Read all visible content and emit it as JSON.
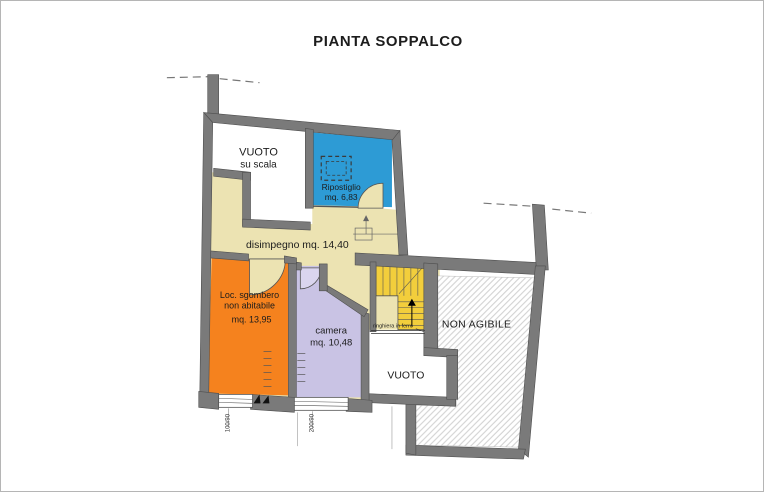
{
  "title": "PIANTA SOPPALCO",
  "rooms": {
    "vuoto_su_scala": {
      "line1": "VUOTO",
      "line2": "su scala"
    },
    "ripostiglio": {
      "name": "Ripostiglio",
      "area": "mq. 6,83"
    },
    "disimpegno": {
      "label": "disimpegno mq. 14,40"
    },
    "loc_sgombero": {
      "line1": "Loc. sgombero",
      "line2": "non abitabile",
      "area": "mq. 13,95"
    },
    "camera": {
      "name": "camera",
      "area": "mq. 10,48"
    },
    "non_agibile": {
      "label": "NON AGIBILE"
    },
    "vuoto": {
      "label": "VUOTO"
    },
    "ringhiera": {
      "label": "ringhiera in ferro"
    }
  },
  "annotations": {
    "window_left_dim": "100/90",
    "window_right_dim": "200/90"
  },
  "colors": {
    "wall": "#7a7a7a",
    "disimpegno": "#ece3b2",
    "ripostiglio": "#2d9bd5",
    "sgombero": "#f5821e",
    "camera": "#c9c3e4",
    "camera_light": "#dad5ee",
    "stairs": "#f2ce3c"
  }
}
